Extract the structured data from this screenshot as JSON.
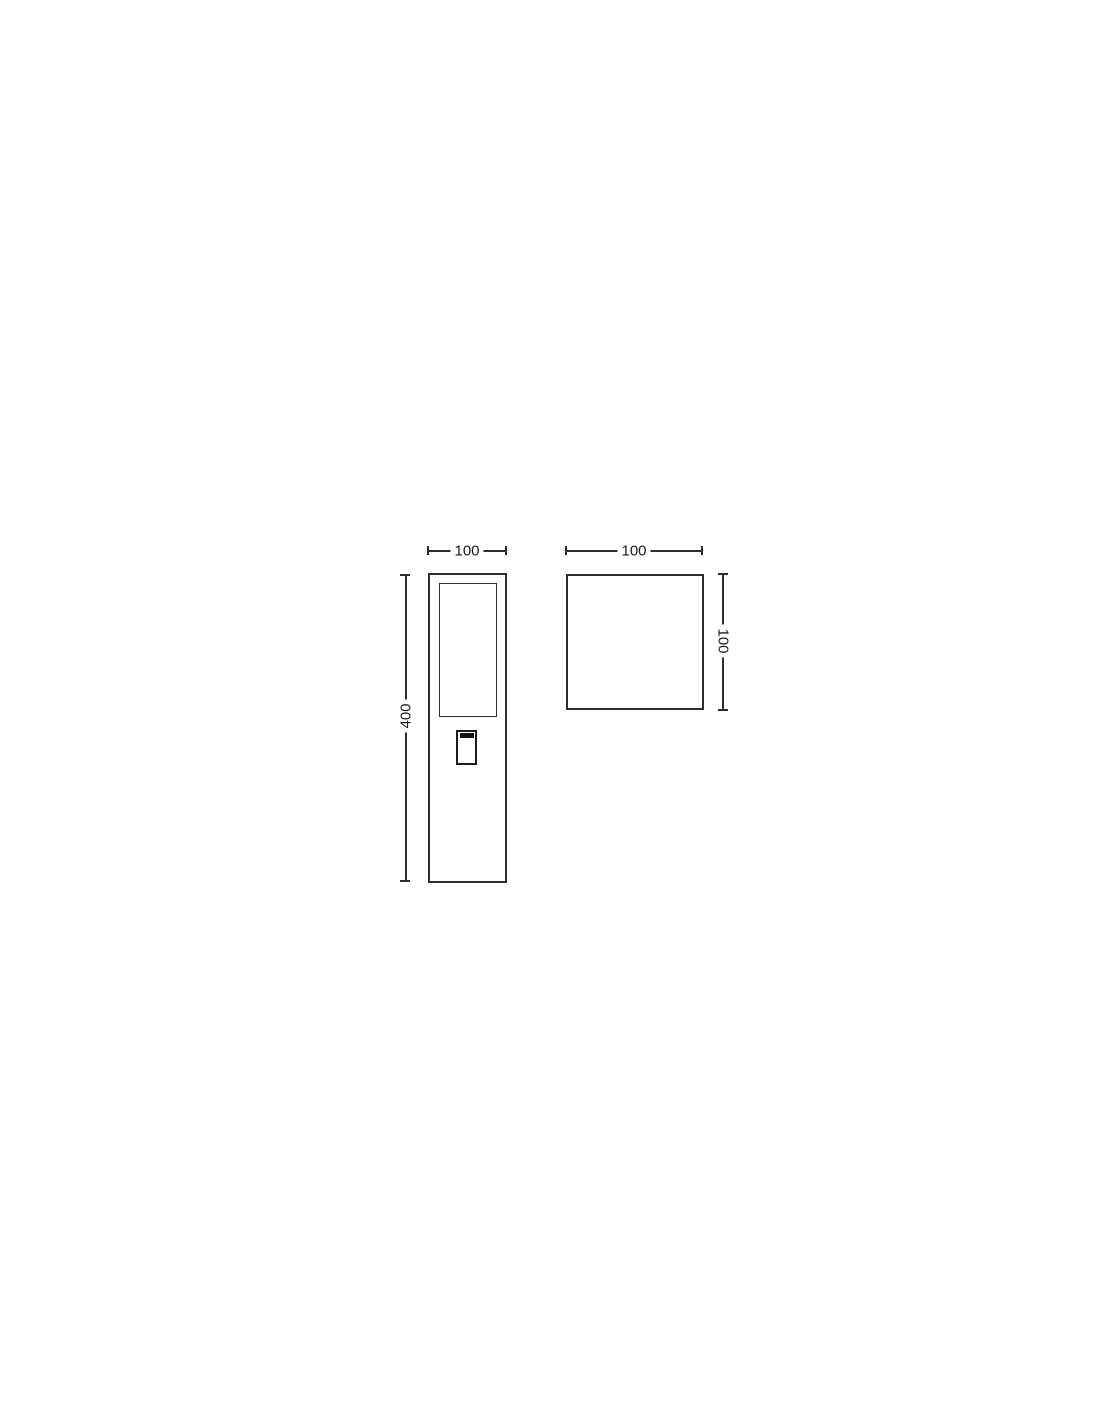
{
  "colors": {
    "line": "#2e2e2e",
    "text": "#1a1a1a",
    "slot": "#111111",
    "background": "#ffffff"
  },
  "drawing": {
    "kind": "technical-dimension-drawing",
    "views": {
      "front": {
        "name": "front-elevation-view",
        "width_dim": "100",
        "height_dim": "400",
        "width_mm": 100,
        "height_mm": 400
      },
      "top": {
        "name": "top-plan-view",
        "width_dim": "100",
        "depth_dim": "100",
        "width_mm": 100,
        "depth_mm": 100
      }
    }
  }
}
